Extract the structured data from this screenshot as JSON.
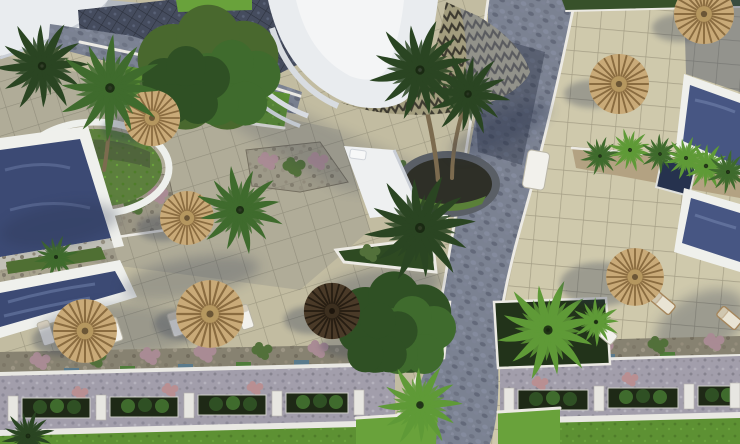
{
  "scene": {
    "type": "3D architectural aerial render",
    "description": "Top-down aerial view of a resort complex pool deck: tiled sun terraces with thatched palapa umbrellas and white sun loungers, four blue pool sections (two at the left edge, two at the right edge), palm trees in round and rectangular planters, a sweeping curved white building roof with a zigzag-patterned section at the top, a dark paved plaza at the upper left, a cobblestone road running from the top down to a bottom intersection, and landscaped planter rows with white curbs and hedge boxes above a lawn strip at the bottom.",
    "lighting": "sunny daytime, shadows cast toward the lower left"
  },
  "colors": {
    "deck_tile": "#c2bca1",
    "deck_tile_right": "#cfc9ac",
    "tile_line": "#8e8973",
    "road_cobble": "#7b8292",
    "plaza_dark": "#454c5e",
    "gravel_path": "#a29eab",
    "pool_border": "#eff0ec",
    "pool_water": "#3c4a74",
    "pool_water_right": "#475683",
    "jacuzzi": "#26324e",
    "lawn": "#5d9133",
    "lawn_bright": "#69a23b",
    "hedge": "#37512a",
    "palm_dark": "#2a4522",
    "palm_mid": "#3f6b2d",
    "palm_bright": "#5f9a37",
    "umbrella_thatch": "#c9aa78",
    "umbrella_spokes": "#8a6c40",
    "umbrella_dark": "#4a3a28",
    "roof_white": "#e9ecef",
    "roof_inner": "#f4f5f6",
    "zigzag_base": "#a39d7e",
    "zigzag_line": "#3d3a30",
    "walkway_white": "#eef0f1",
    "stone_planter": "#8a8577",
    "soil": "#b3a282",
    "planter_box_dark": "#1e2916",
    "curb": "#e9e8e3",
    "lounger": "#f2f1ec",
    "shadow": "#2b3550"
  },
  "inventory": {
    "pool_sections": 4,
    "thatched_umbrellas": 7,
    "dark_umbrellas": 1,
    "sun_loungers": 9,
    "large_palm_trees": 8,
    "small_palms": 9,
    "round_green_trees": 2,
    "hedge_planter_boxes": 7,
    "planter_posts": 9,
    "roads": "one cobblestone road from top centre-right to a four-way intersection at bottom centre, plus a dark paved plaza upper-left"
  }
}
